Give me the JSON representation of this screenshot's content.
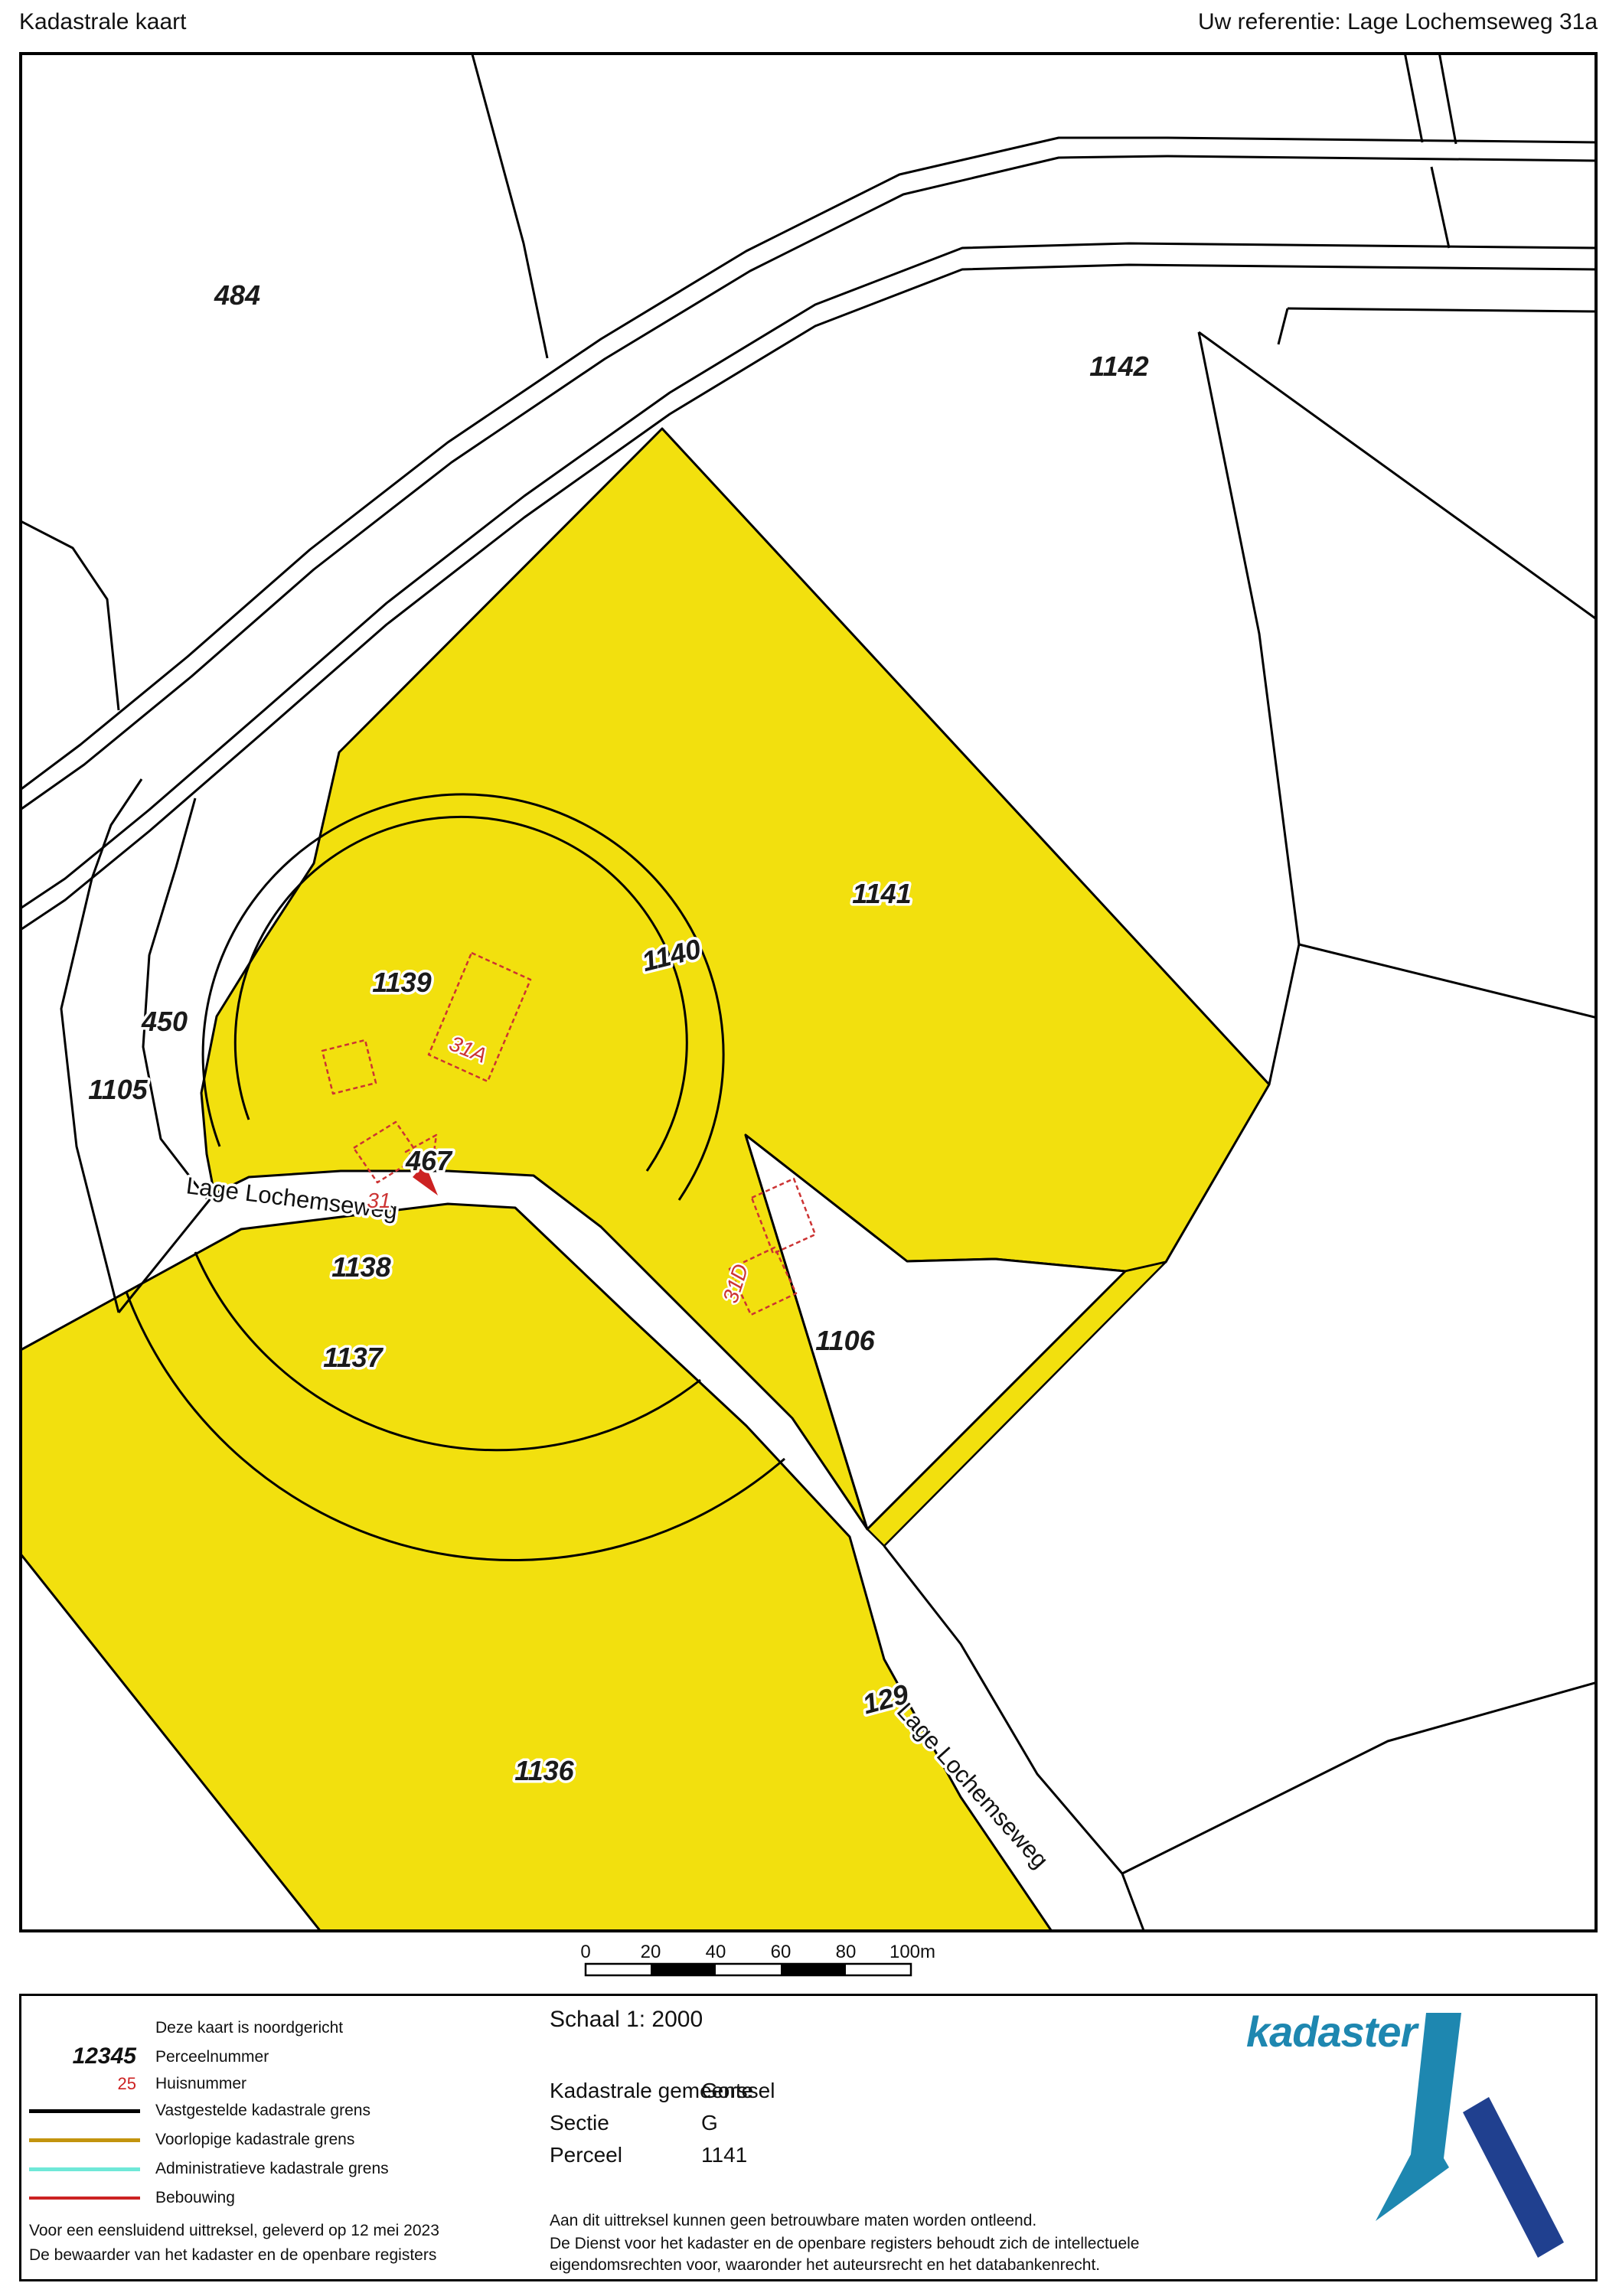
{
  "header": {
    "title": "Kadastrale kaart",
    "reference": "Uw referentie: Lage Lochemseweg 31a"
  },
  "map": {
    "parcel_labels": [
      "484",
      "1142",
      "1141",
      "1140",
      "1139",
      "450",
      "1105",
      "467",
      "1138",
      "1137",
      "1106",
      "1136",
      "129"
    ],
    "road_label": "Lage Lochemseweg",
    "house_number_labels": {
      "arrow": "31",
      "a": "31A",
      "d": "31D"
    },
    "highlight_color": "#F2E00E",
    "building_color": "#CC3333",
    "boundary_color": "#000000"
  },
  "scalebar": {
    "labels": [
      "0",
      "20",
      "40",
      "60",
      "80",
      "100m"
    ]
  },
  "legend": {
    "north_note": "Deze kaart is noordgericht",
    "items": [
      {
        "sample": "12345",
        "label": "Perceelnummer"
      },
      {
        "sample": "25",
        "label": "Huisnummer",
        "sample_color": "#CC2222"
      },
      {
        "line_color": "#000000",
        "label": "Vastgestelde kadastrale grens"
      },
      {
        "line_color": "#C3940E",
        "label": "Voorlopige kadastrale grens"
      },
      {
        "line_color": "#6FE8D8",
        "label": "Administratieve kadastrale grens"
      },
      {
        "line_color": "#CC2222",
        "label": "Bebouwing"
      }
    ],
    "footer_line1": "Voor een eensluidend uittreksel, geleverd op 12 mei 2023",
    "footer_line2": "De bewaarder van het kadaster en de openbare registers"
  },
  "info": {
    "scale": "Schaal 1: 2000",
    "rows": [
      {
        "label": "Kadastrale gemeente",
        "value": "Gorssel"
      },
      {
        "label": "Sectie",
        "value": "G"
      },
      {
        "label": "Perceel",
        "value": "1141"
      }
    ],
    "disclaimer1": "Aan dit uittreksel kunnen geen betrouwbare maten worden ontleend.",
    "disclaimer2": "De Dienst voor het kadaster en de openbare registers behoudt zich de intellectuele",
    "disclaimer3": "eigendomsrechten voor, waaronder het auteursrecht en het databankenrecht."
  },
  "logo": {
    "text": "kadaster",
    "color_light": "#1E87B0",
    "color_dark": "#20408F"
  }
}
